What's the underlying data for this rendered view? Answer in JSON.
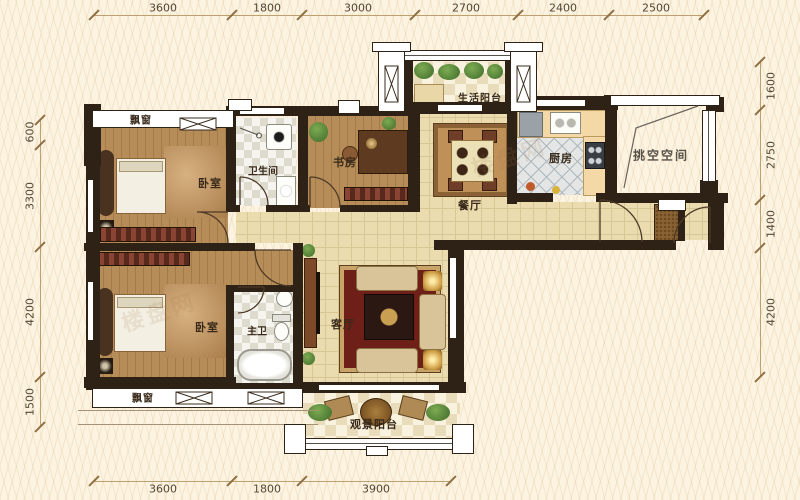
{
  "rooms": {
    "bay_top": "飘窗",
    "bedroom_top": "卧室",
    "bath": "卫生间",
    "study": "书房",
    "life_balcony": "生活阳台",
    "dining": "餐厅",
    "kitchen": "厨房",
    "void": "挑空空间",
    "living": "客厅",
    "bedroom_bottom": "卧室",
    "master_bath": "主卫",
    "view_balcony": "观景阳台",
    "bay_bottom": "飘窗"
  },
  "dims": {
    "top": [
      "3600",
      "1800",
      "3000",
      "2700",
      "2400",
      "2500"
    ],
    "bottom": [
      "3600",
      "1800",
      "3900"
    ],
    "left": [
      "600",
      "3300",
      "4200",
      "1500"
    ],
    "right": [
      "1600",
      "2750",
      "1400",
      "4200"
    ]
  },
  "watermark": "楼盘网",
  "colors": {
    "wall": "#2e2116",
    "wood_floor": "#b68d58",
    "tile_floor": "#ebdcb0",
    "background": "#fcf3e1",
    "plant_green": "#5d8c3e",
    "rug_red": "#6e2018"
  }
}
